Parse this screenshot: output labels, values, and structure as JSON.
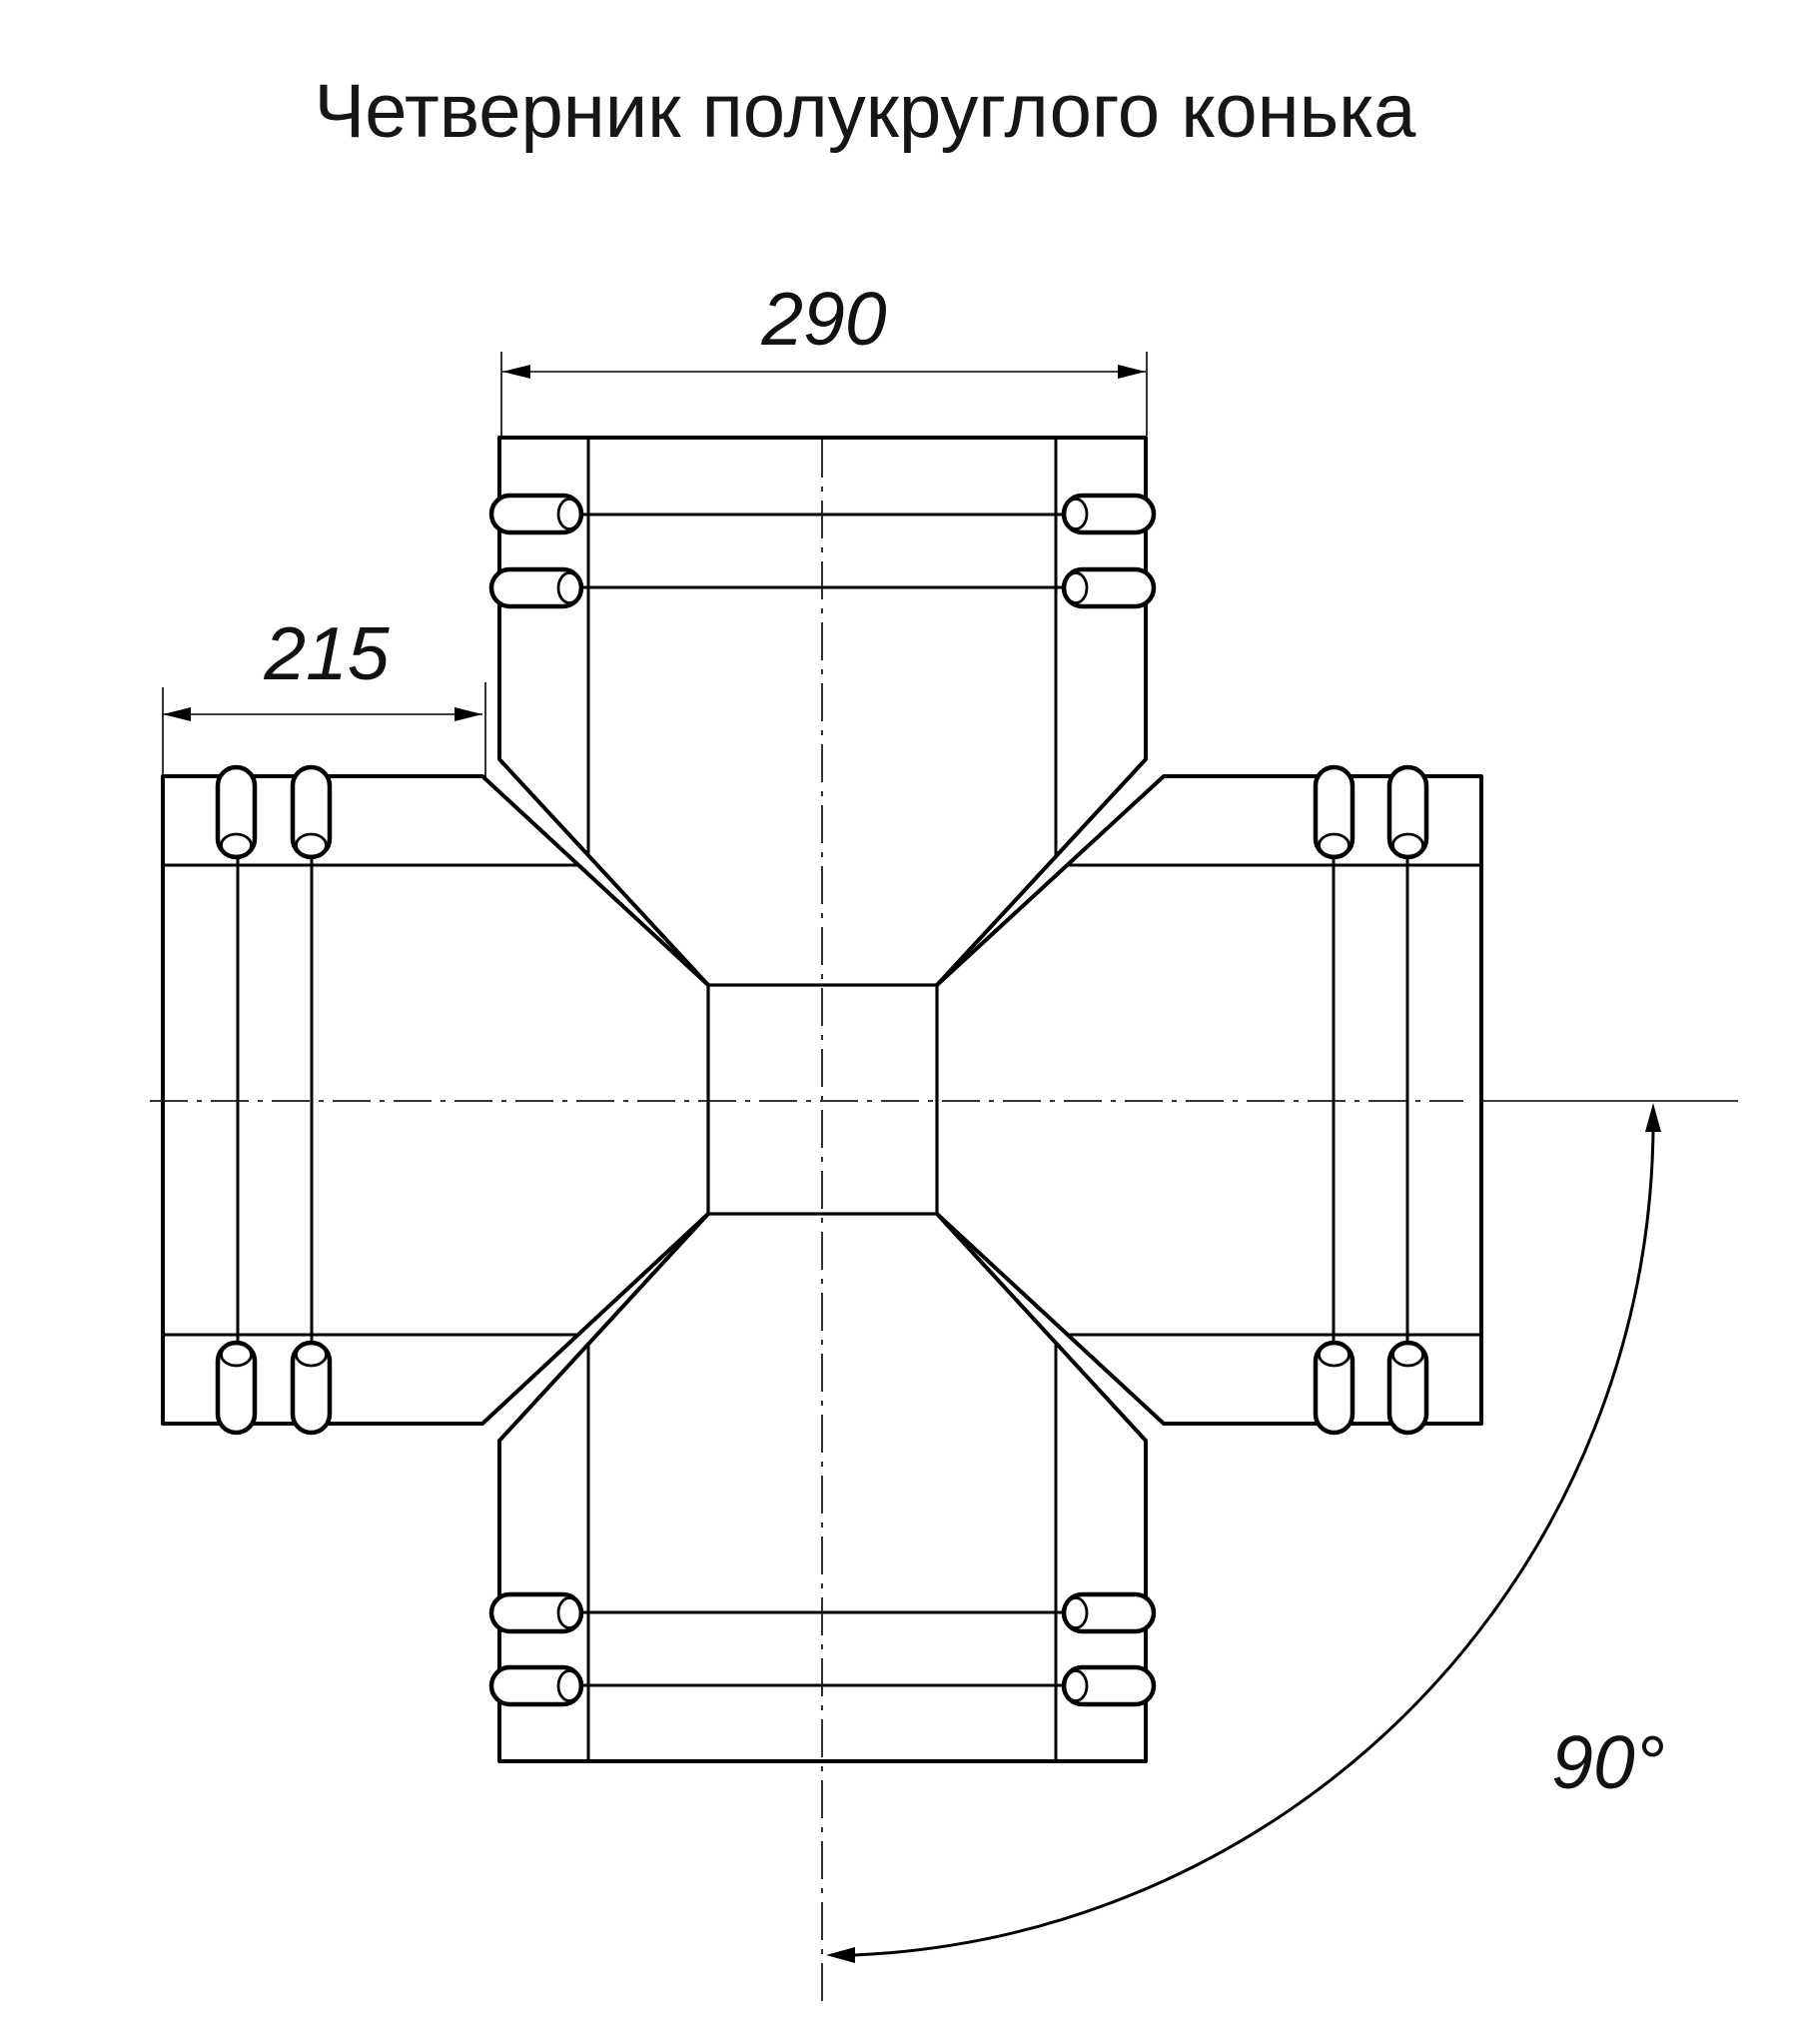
{
  "title": "Четверник полукруглого конька",
  "dimensions": {
    "top_width": "290",
    "side_length": "215",
    "angle": "90°"
  },
  "colors": {
    "line": "#000000",
    "text": "#161616",
    "background": "#ffffff"
  }
}
